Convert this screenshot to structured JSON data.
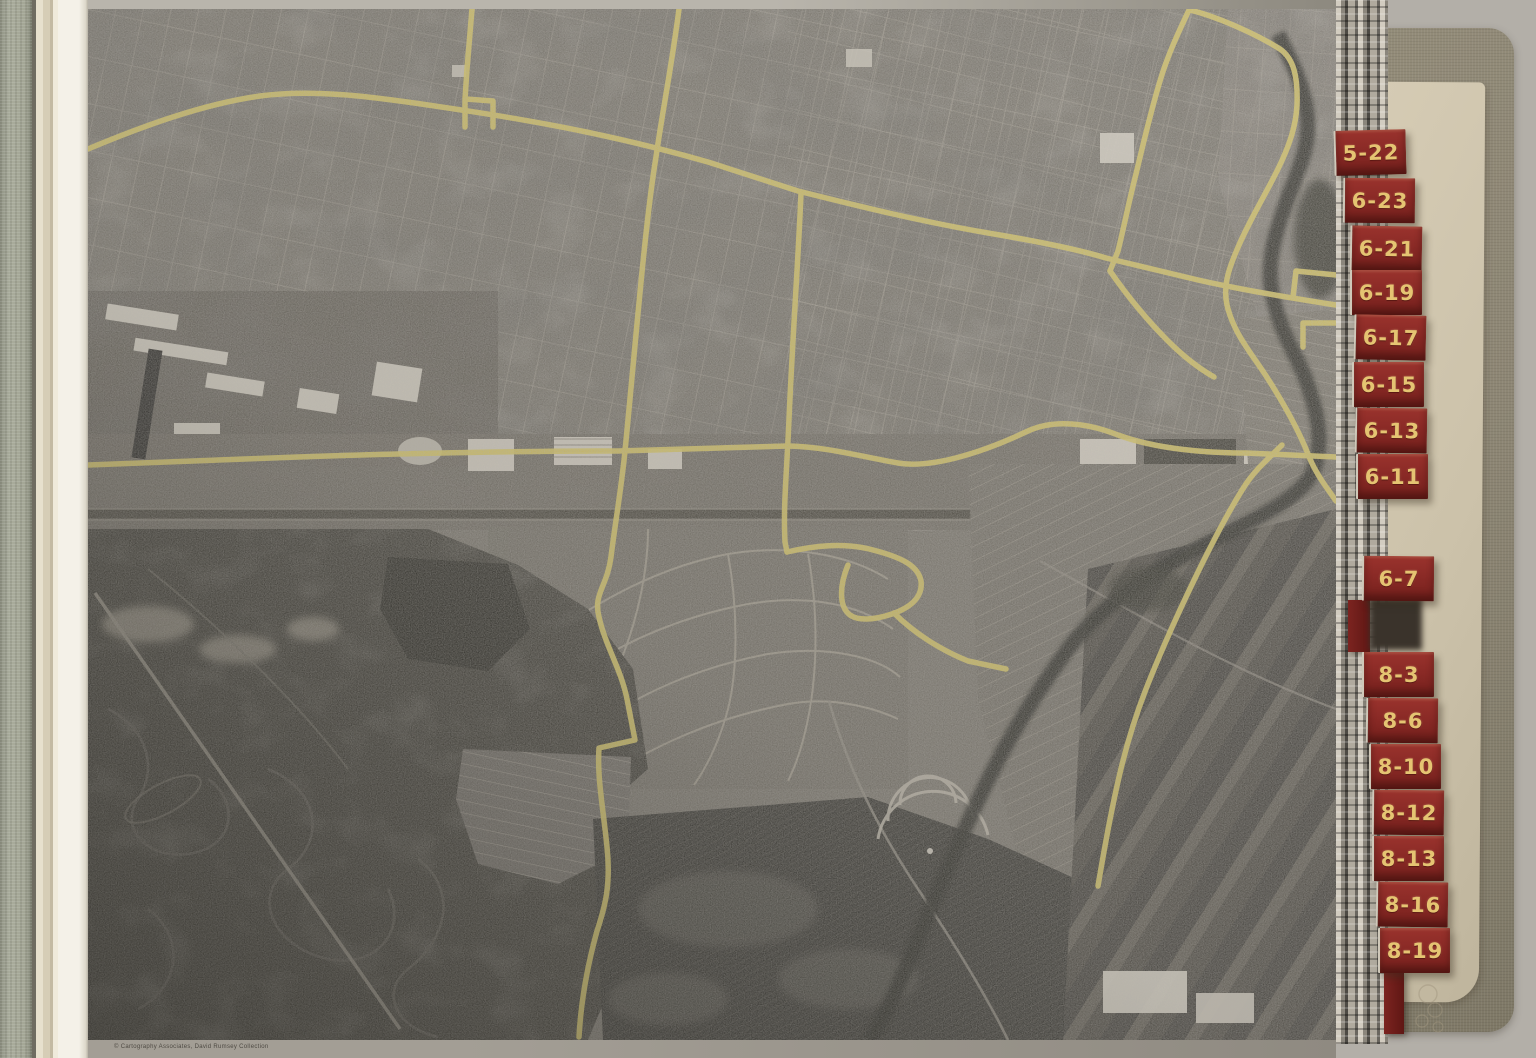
{
  "book": {
    "kind": "aerial-photo-atlas-scanned-page",
    "copyright": "© Cartography Associates, David Rumsey Collection",
    "tabs": [
      "5-22",
      "6-23",
      "6-21",
      "6-19",
      "6-17",
      "6-15",
      "6-13",
      "6-11",
      "6-7",
      "8-3",
      "8-6",
      "8-10",
      "8-12",
      "8-13",
      "8-16",
      "8-19"
    ],
    "colors": {
      "tab_red": "#8a2a26",
      "tab_gold": "#e5c472",
      "cover_khaki": "#8d8674",
      "inner_page_tan": "#ccc2aa",
      "binding_sage": "#a9ac9c",
      "page_white": "#f4f1e8",
      "photo_grey": "#6e6a62",
      "road_annotation_yellow": "#d6c45c",
      "scanner_background": "#b3afa8"
    },
    "photo": {
      "description_label": "black-and-white aerial photograph with yellow road overlay",
      "features": [
        "dense-street-grid-north",
        "rail-industrial-corridor",
        "curvy-suburban-tracts",
        "tidal-marsh-southwest",
        "plowed-farm-fields-south",
        "tree-lined-stream-east",
        "drive-in-theater",
        "factories"
      ]
    }
  }
}
